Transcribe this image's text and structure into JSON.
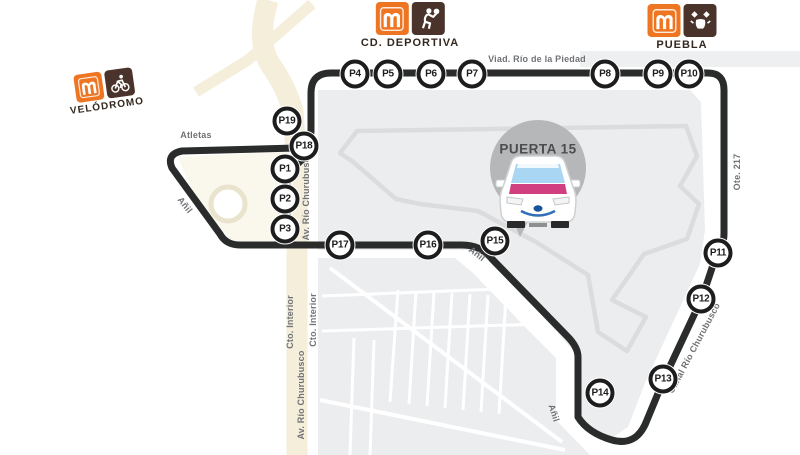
{
  "gate": {
    "label": "PUERTA 15"
  },
  "stations": [
    {
      "id": "velodromo",
      "name": "VELÓDROMO",
      "icon": "cyclist-icon"
    },
    {
      "id": "cd-deportiva",
      "name": "CD. DEPORTIVA",
      "icon": "athlete-icon"
    },
    {
      "id": "puebla",
      "name": "PUEBLA",
      "icon": "talavera-icon"
    }
  ],
  "stops": [
    {
      "label": "P1",
      "x": 285,
      "y": 169
    },
    {
      "label": "P2",
      "x": 285,
      "y": 199
    },
    {
      "label": "P3",
      "x": 285,
      "y": 229
    },
    {
      "label": "P4",
      "x": 355,
      "y": 74
    },
    {
      "label": "P5",
      "x": 388,
      "y": 74
    },
    {
      "label": "P6",
      "x": 431,
      "y": 74
    },
    {
      "label": "P7",
      "x": 472,
      "y": 74
    },
    {
      "label": "P8",
      "x": 605,
      "y": 74
    },
    {
      "label": "P9",
      "x": 658,
      "y": 74
    },
    {
      "label": "P10",
      "x": 689,
      "y": 74
    },
    {
      "label": "P11",
      "x": 718,
      "y": 253
    },
    {
      "label": "P12",
      "x": 701,
      "y": 299
    },
    {
      "label": "P13",
      "x": 663,
      "y": 379
    },
    {
      "label": "P14",
      "x": 600,
      "y": 393
    },
    {
      "label": "P15",
      "x": 495,
      "y": 241
    },
    {
      "label": "P16",
      "x": 428,
      "y": 245
    },
    {
      "label": "P17",
      "x": 340,
      "y": 245
    },
    {
      "label": "P18",
      "x": 304,
      "y": 146
    },
    {
      "label": "P19",
      "x": 287,
      "y": 121
    }
  ],
  "streets": [
    {
      "label": "Viad. Río de la Piedad",
      "x": 537,
      "y": 59,
      "rotate": 0
    },
    {
      "label": "Atletas",
      "x": 196,
      "y": 135,
      "rotate": 0
    },
    {
      "label": "Añil",
      "x": 185,
      "y": 205,
      "rotate": 52
    },
    {
      "label": "Añil",
      "x": 477,
      "y": 254,
      "rotate": 38
    },
    {
      "label": "Añil",
      "x": 554,
      "y": 413,
      "rotate": 72
    },
    {
      "label": "Av. Río Churubusco",
      "x": 306,
      "y": 196,
      "rotate": -90
    },
    {
      "label": "Av. Río Churubusco",
      "x": 301,
      "y": 395,
      "rotate": -90
    },
    {
      "label": "Cto. Interior",
      "x": 290,
      "y": 322,
      "rotate": -90
    },
    {
      "label": "Cto. Interior",
      "x": 313,
      "y": 320,
      "rotate": -90
    },
    {
      "label": "Ote. 217",
      "x": 737,
      "y": 172,
      "rotate": -90
    },
    {
      "label": "Canal Río Churubusco",
      "x": 694,
      "y": 348,
      "rotate": -62
    }
  ],
  "colors": {
    "metro_orange": "#ee7623",
    "metro_brown": "#4a332a",
    "route_black": "#2a2b2b",
    "map_fill": "#ecedee",
    "track_gray": "#dadcdd",
    "road_beige": "#f4eeda",
    "pin_gray": "#b5b7b9",
    "taxi_pink": "#d13f80",
    "taxi_windshield": "#a9d6f2",
    "label_gray": "#707276"
  }
}
